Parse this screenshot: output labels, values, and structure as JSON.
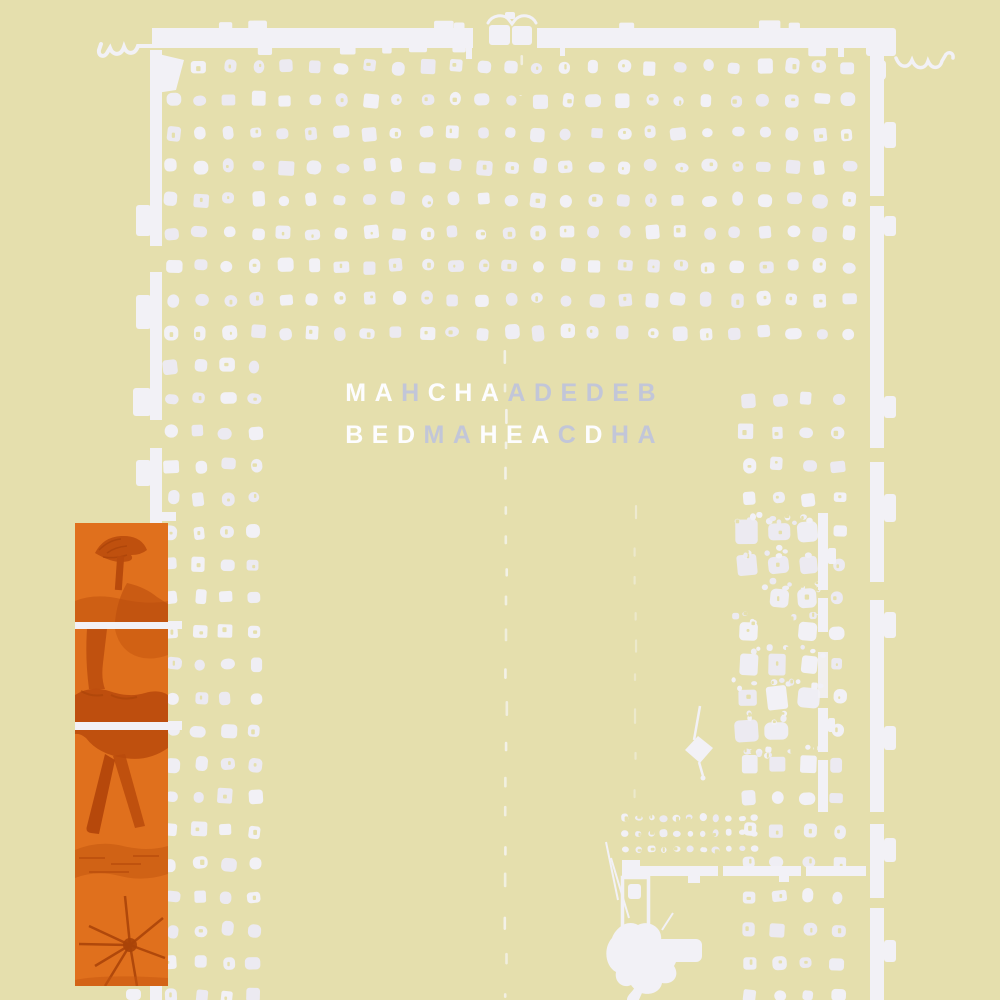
{
  "artwork": {
    "line1_text": "MAHCHAADEDEB",
    "line2_text": "BEDMAHEACDHA",
    "lines": [
      {
        "letters": [
          {
            "ch": "M",
            "tone": "white"
          },
          {
            "ch": "A",
            "tone": "white"
          },
          {
            "ch": "H",
            "tone": "gray"
          },
          {
            "ch": "C",
            "tone": "white"
          },
          {
            "ch": "H",
            "tone": "white"
          },
          {
            "ch": "A",
            "tone": "white"
          },
          {
            "ch": "A",
            "tone": "gray"
          },
          {
            "ch": "D",
            "tone": "gray"
          },
          {
            "ch": "E",
            "tone": "gray"
          },
          {
            "ch": "D",
            "tone": "gray"
          },
          {
            "ch": "E",
            "tone": "gray"
          },
          {
            "ch": "B",
            "tone": "gray"
          }
        ]
      },
      {
        "letters": [
          {
            "ch": "B",
            "tone": "white"
          },
          {
            "ch": "E",
            "tone": "white"
          },
          {
            "ch": "D",
            "tone": "white"
          },
          {
            "ch": "M",
            "tone": "gray"
          },
          {
            "ch": "A",
            "tone": "gray"
          },
          {
            "ch": "H",
            "tone": "white"
          },
          {
            "ch": "E",
            "tone": "white"
          },
          {
            "ch": "A",
            "tone": "white"
          },
          {
            "ch": "C",
            "tone": "gray"
          },
          {
            "ch": "D",
            "tone": "white"
          },
          {
            "ch": "H",
            "tone": "gray"
          },
          {
            "ch": "A",
            "tone": "gray"
          }
        ]
      }
    ]
  },
  "colors": {
    "background": "#e5dfad",
    "plan_white": "#f2f1f6",
    "dot_white": "#efeef4",
    "letter_white": "#fdfdff",
    "letter_gray": "#c2c6d8",
    "panel_orange": "#e0701d",
    "panel_orange_dark": "#b84a0c"
  },
  "decoration": {
    "panel_images": [
      "orange-tree-photo-top",
      "orange-tree-photo-middle",
      "orange-tree-photo-bottom"
    ]
  }
}
